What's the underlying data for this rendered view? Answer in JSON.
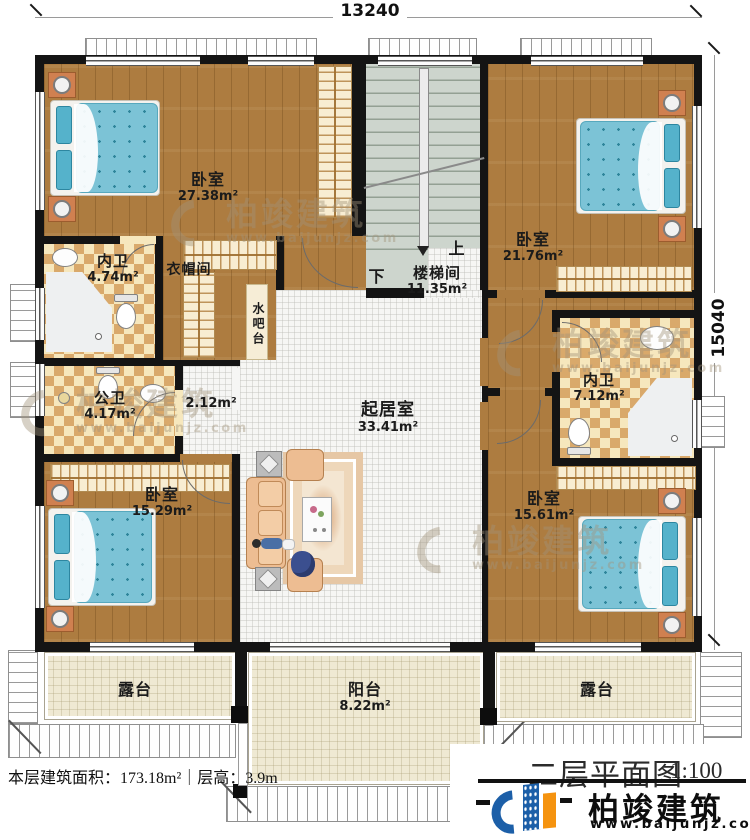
{
  "dimensions": {
    "top": "13240",
    "right": "15040"
  },
  "rooms": {
    "bedroom_tl": {
      "name": "卧室",
      "area": "27.38m²"
    },
    "bath_tl": {
      "name": "内卫",
      "area": "4.74m²"
    },
    "cloakroom": {
      "name": "衣帽间"
    },
    "water_bar": {
      "name": "水吧台"
    },
    "public_bath": {
      "name": "公卫",
      "area": "4.17m²"
    },
    "small_closet": {
      "area": "2.12m²"
    },
    "bedroom_bl": {
      "name": "卧室",
      "area": "15.29m²"
    },
    "living": {
      "name": "起居室",
      "area": "33.41m²"
    },
    "stairwell": {
      "name": "楼梯间",
      "area": "11.35m²",
      "up_label": "上",
      "down_label": "下"
    },
    "bedroom_tr": {
      "name": "卧室",
      "area": "21.76m²"
    },
    "bath_r": {
      "name": "内卫",
      "area": "7.12m²"
    },
    "bedroom_br": {
      "name": "卧室",
      "area": "15.61m²"
    },
    "terrace_left": {
      "name": "露台"
    },
    "balcony": {
      "name": "阳台",
      "area": "8.22m²"
    },
    "terrace_right": {
      "name": "露台"
    }
  },
  "footer": {
    "area_label": "本层建筑面积：",
    "area_value": "173.18m²",
    "separator": "｜",
    "height_label": "层高：",
    "height_value": "3.9m"
  },
  "title_block": {
    "title": "二层平面图",
    "scale": "1:100"
  },
  "brand": {
    "name": "柏竣建筑",
    "url": "www.baijunjz.com"
  },
  "colors": {
    "wall": "#141414",
    "wood": "#ad7c40",
    "tile_light": "#f6e7bd",
    "tile_dark": "#d9a96b",
    "bed": "#7cc3d6",
    "stair": "#cdd5cd",
    "terrace": "#efe9d3",
    "brand_blue": "#1c5fa8",
    "brand_orange": "#f5930f"
  }
}
